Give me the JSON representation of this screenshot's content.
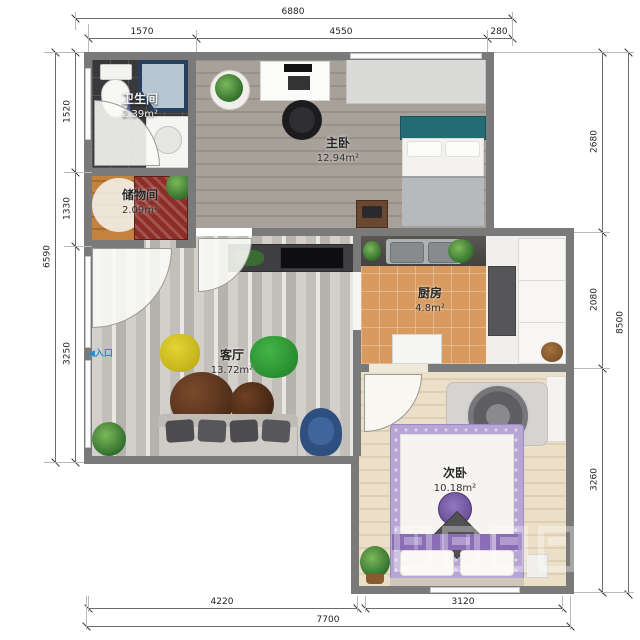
{
  "plan": {
    "rooms": {
      "bathroom": {
        "name": "卫生间",
        "area": "2.39m²"
      },
      "storage": {
        "name": "储物间",
        "area": "2.09m²"
      },
      "master_bedroom": {
        "name": "主卧",
        "area": "12.94m²"
      },
      "kitchen": {
        "name": "厨房",
        "area": "4.8m²"
      },
      "living_room": {
        "name": "客厅",
        "area": "13.72m²"
      },
      "second_bedroom": {
        "name": "次卧",
        "area": "10.18m²"
      }
    },
    "entrance": {
      "label": "入口",
      "arrow": "◀"
    }
  },
  "dimensions": {
    "top": {
      "overall": "6880",
      "segments": [
        "1570",
        "4550",
        "280"
      ]
    },
    "left": {
      "overall": "6590",
      "segments": [
        "1520",
        "1330",
        "3250"
      ]
    },
    "right": {
      "overall": "8500",
      "segments": [
        "2680",
        "2080",
        "3260"
      ]
    },
    "bottom": {
      "overall": "7700",
      "segments": [
        "4220",
        "3120"
      ]
    }
  },
  "colors": {
    "wall": "#7a7a7a",
    "entrance_accent": "#1e8fd8",
    "master_bed_teal": "#256b74",
    "second_bed_purple": "#8a6db4",
    "kitchen_floor": "#d89a5e",
    "bathroom_floor": "#39393b"
  }
}
